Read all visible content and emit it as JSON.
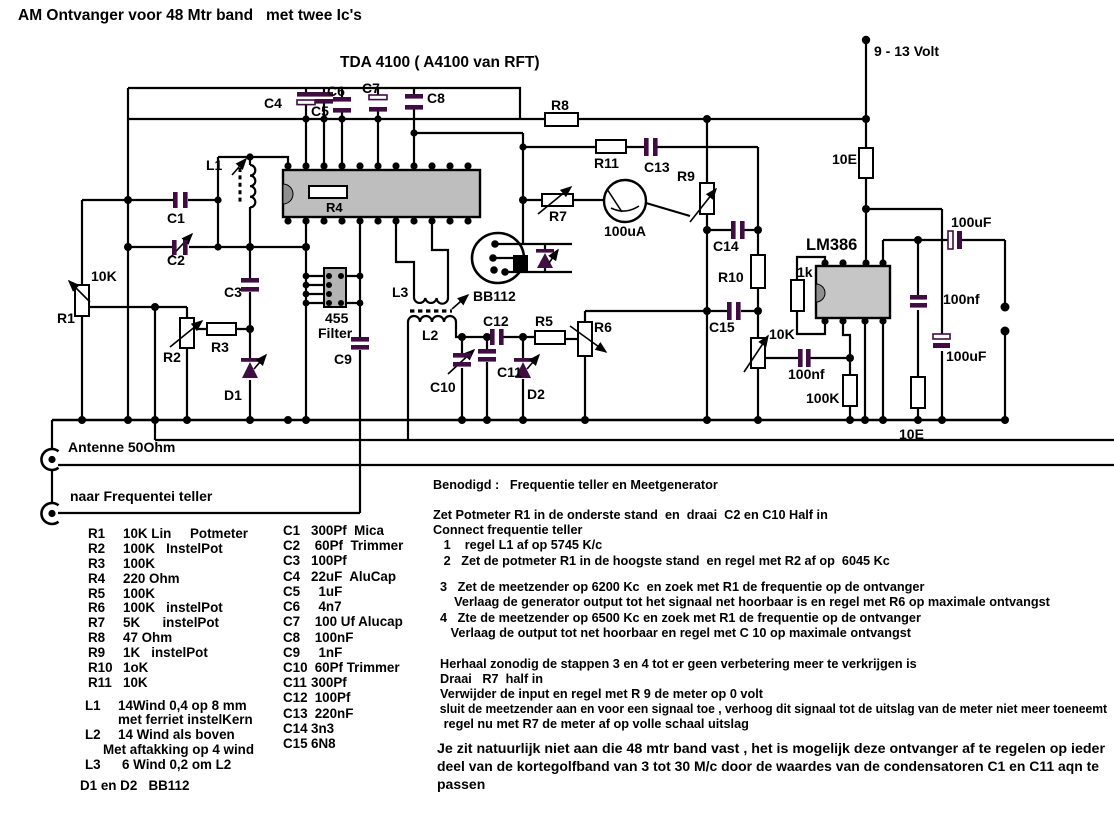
{
  "title": "AM Ontvanger voor 48 Mtr band   met twee Ic's",
  "colors": {
    "wire": "#000000",
    "capacitor": "#400d43",
    "ic_fill": "#bebebe",
    "filter_fill": "#b3b3b3"
  },
  "schematic": {
    "ic1_label": "TDA 4100 ( A4100 van RFT)",
    "ic2_label": "LM386",
    "supply_label": "9 - 13 Volt",
    "meter_label": "100uA",
    "bb112_label": "BB112",
    "filter_line1": "455",
    "filter_line2": "Filter",
    "antenna_label": "Antenne 50Ohm",
    "freq_label": "naar Frequentei teller",
    "labels": {
      "c1": "C1",
      "c2": "C2",
      "c3": "C3",
      "c4": "C4",
      "c5": "C5",
      "c6": "C6",
      "c7": "C7",
      "c8": "C8",
      "c9": "C9",
      "c10": "C10",
      "c11": "C11",
      "c12": "C12",
      "c13": "C13",
      "c14": "C14",
      "c15": "C15",
      "r1": "R1",
      "r2": "R2",
      "r3": "R3",
      "r4": "R4",
      "r5": "R5",
      "r6": "R6",
      "r7": "R7",
      "r8": "R8",
      "r9": "R9",
      "r10": "R10",
      "r11": "R11",
      "l1": "L1",
      "l2": "L2",
      "l3": "L3",
      "d1": "D1",
      "d2": "D2"
    },
    "values": {
      "r1_val": "10K",
      "r10e_top": "10E",
      "r1k": "1k",
      "pot10k": "10K",
      "cap100nf_left": "100nf",
      "r100k": "100K",
      "cap100uf_top": "100uF",
      "cap100nf_right": "100nf",
      "cap100uf_bottom": "100uF",
      "r10e_bottom": "10E"
    }
  },
  "parts": {
    "resistors": [
      {
        "ref": "R1",
        "value": "10K Lin     Potmeter"
      },
      {
        "ref": "R2",
        "value": "100K   InstelPot"
      },
      {
        "ref": "R3",
        "value": "100K"
      },
      {
        "ref": "R4",
        "value": "220 Ohm"
      },
      {
        "ref": "R5",
        "value": "100K"
      },
      {
        "ref": "R6",
        "value": "100K   instelPot"
      },
      {
        "ref": "R7",
        "value": "5K      instelPot"
      },
      {
        "ref": "R8",
        "value": "47 Ohm"
      },
      {
        "ref": "R9",
        "value": "1K   instelPot"
      },
      {
        "ref": "R10",
        "value": "1oK"
      },
      {
        "ref": "R11",
        "value": "10K"
      }
    ],
    "capacitors": [
      {
        "ref": "C1",
        "value": "300Pf  Mica"
      },
      {
        "ref": "C2",
        "value": " 60Pf  Trimmer"
      },
      {
        "ref": "C3",
        "value": "100Pf"
      },
      {
        "ref": "C4",
        "value": "22uF  AluCap"
      },
      {
        "ref": "C5",
        "value": "  1uF"
      },
      {
        "ref": "C6",
        "value": "  4n7"
      },
      {
        "ref": "C7",
        "value": " 100 Uf Alucap"
      },
      {
        "ref": "C8",
        "value": " 100nF"
      },
      {
        "ref": "C9",
        "value": "  1nF"
      },
      {
        "ref": "C10",
        "value": " 60Pf Trimmer"
      },
      {
        "ref": "C11",
        "value": "300Pf"
      },
      {
        "ref": "C12",
        "value": " 100Pf"
      },
      {
        "ref": "C13",
        "value": " 220nF"
      },
      {
        "ref": "C14",
        "value": "3n3"
      },
      {
        "ref": "C15",
        "value": "6N8"
      }
    ],
    "coils": {
      "l1_ref": "L1",
      "l1_a": "14Wind 0,4 op 8 mm",
      "l1_b": "met ferriet instelKern",
      "l2_ref": "L2",
      "l2_a": "14 Wind als boven",
      "l2_b": "Met aftakking op 4 wind",
      "l3_ref": "L3",
      "l3_a": "6 Wind 0,2 om L2",
      "diodes": "D1 en D2   BB112"
    }
  },
  "instructions": {
    "heading": "Benodigd :   Frequentie teller en Meetgenerator",
    "lines": [
      "Zet Potmeter R1 in de onderste stand  en  draai  C2 en C10 Half in",
      "Connect frequentie teller",
      "   1    regel L1 af op 5745 K/c",
      "   2   Zet de potmeter R1 in de hoogste stand  en regel met R2 af op  6045 Kc",
      "  3   Zet de meetzender op 6200 Kc  en zoek met R1 de frequentie op de ontvanger",
      "      Verlaag de generator output tot het signaal net hoorbaar is en regel met R6 op maximale ontvangst",
      "  4   Zte de meetzender op 6500 Kc en zoek met R1 de frequentie op de ontvanger",
      "     Verlaag de output tot net hoorbaar en regel met C 10 op maximale ontvangst",
      "  Herhaal zonodig de stappen 3 en 4 tot er geen verbetering meer te verkrijgen is",
      "  Draai   R7  half in",
      "  Verwijder de input en regel met R 9 de meter op 0 volt",
      "  sluit de meetzender aan en voor een signaal toe , verhoog dit signaal tot de uitslag van de meter niet meer toeneemt",
      "   regel nu met R7 de meter af op volle schaal uitslag"
    ],
    "footer": [
      "Je zit natuurlijk niet aan die 48 mtr band vast , het is mogelijk deze ontvanger af te regelen op ieder",
      "deel van de kortegolfband van 3 tot 30 M/c door de waardes van de condensatoren C1 en C11 aqn te",
      "passen"
    ]
  }
}
